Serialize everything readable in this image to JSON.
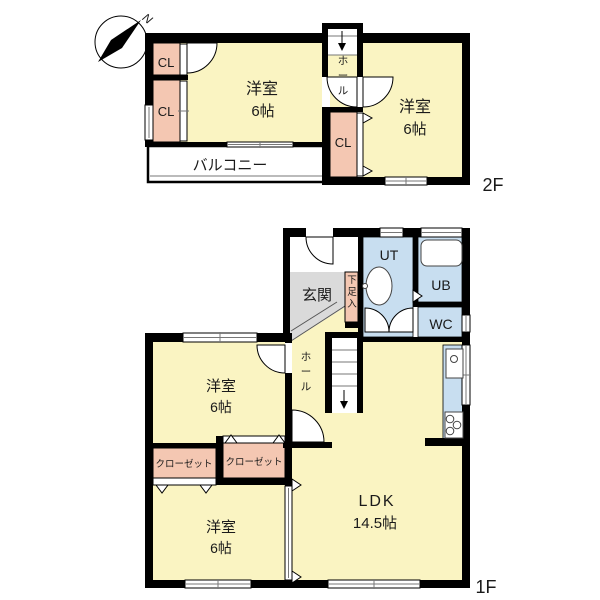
{
  "compass": {
    "label": "N"
  },
  "colors": {
    "room": "#FAF4C2",
    "closet": "#F4C7B2",
    "water": "#C8DEF0",
    "entrance": "#DADADA",
    "wall": "#000000",
    "background": "#FFFFFF"
  },
  "f2": {
    "label": "2F",
    "bedroom_left": {
      "name": "洋室",
      "size": "6帖"
    },
    "bedroom_right": {
      "name": "洋室",
      "size": "6帖"
    },
    "closet_top": "CL",
    "closet_bottom": "CL",
    "closet_center": "CL",
    "hall": "ホール",
    "balcony": "バルコニー"
  },
  "f1": {
    "label": "1F",
    "entrance": "玄関",
    "shoe": "下足入",
    "ut": "UT",
    "ub": "UB",
    "wc": "WC",
    "hall": "ホール",
    "bedroom_upper": {
      "name": "洋室",
      "size": "6帖"
    },
    "closet_left": "クローゼット",
    "closet_right": "クローゼット",
    "bedroom_lower": {
      "name": "洋室",
      "size": "6帖"
    },
    "ldk": {
      "name": "LDK",
      "size": "14.5帖"
    }
  }
}
